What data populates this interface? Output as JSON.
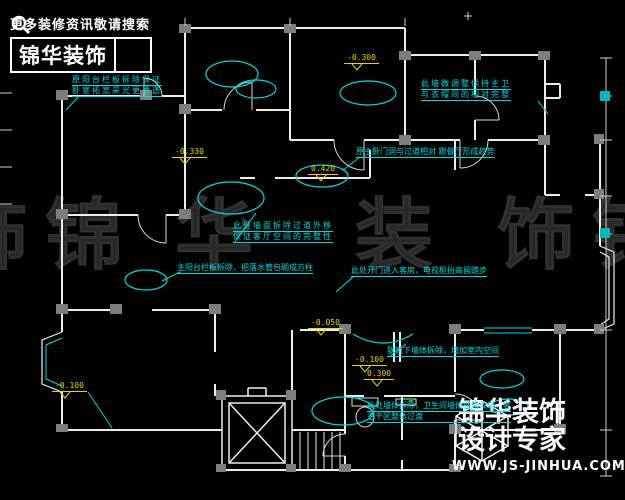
{
  "branding": {
    "top_banner": {
      "tagline": "更多装修资讯敬请搜索",
      "brand": "锦华装饰",
      "icon": "magnifier-icon"
    },
    "bottom_logo": {
      "brand": "锦华装饰",
      "subtitle": "设计专家",
      "website": "WWW.JS-JINHUA.COM",
      "icon": "cube-logo-icon"
    }
  },
  "watermark": {
    "chars": [
      "锦",
      "华",
      "装",
      "饰"
    ]
  },
  "annotations": [
    {
      "lines": [
        "原阳台栏板拆除保证",
        "卧室拓宽采光更通透"
      ]
    },
    {
      "lines": [
        "此墙微调整保持主卫",
        "与衣帽间的相对完整"
      ]
    },
    {
      "lines": [
        "原主卧门洞与过道相对 跟餐厅形成趋势"
      ]
    },
    {
      "lines": [
        "此处墙面拆除过道外移",
        "保证客厅空间的完整性"
      ]
    },
    {
      "lines": [
        "主阳台栏板拆除，把落水管包砌成方柱"
      ]
    },
    {
      "lines": [
        "此处开门进入客房，电视柜抬高留踏步"
      ]
    },
    {
      "lines": [
        "飘窗下墙体拆除，增加室内空间"
      ]
    },
    {
      "lines": [
        "此处墙体拆除，卫生间墙体格局改造，客",
        "卫干区整体过渡"
      ]
    }
  ],
  "elevations": [
    {
      "value": "-0.300"
    },
    {
      "value": "-0.330"
    },
    {
      "value": "0.420"
    },
    {
      "value": "-0.100"
    },
    {
      "value": "-0.050"
    },
    {
      "value": "-0.100"
    },
    {
      "value": "0.300"
    }
  ],
  "colors": {
    "background": "#000000",
    "walls": "#ededed",
    "annotation_cyan": "#00dcdc",
    "elevation_yellow": "#e8d800",
    "watermark_gray": "#262626",
    "column_gray": "#7d7d7d",
    "teal_marker": "#00b8b8",
    "green_marker": "#00bb00"
  }
}
